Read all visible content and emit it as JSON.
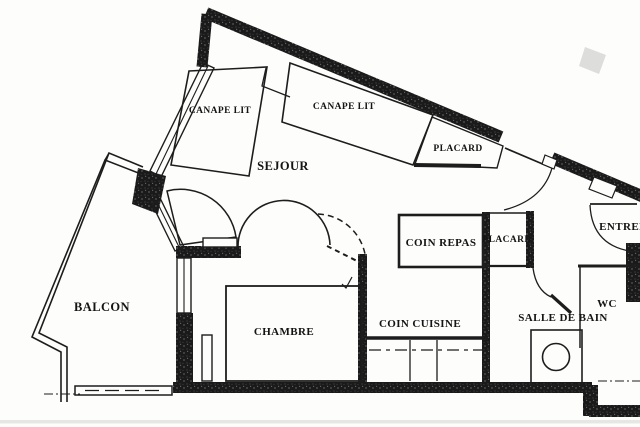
{
  "meta": {
    "type": "apartment-floor-plan",
    "language": "fr"
  },
  "colors": {
    "paper": "#fdfdfb",
    "ink": "#1d1d1d",
    "wall": "#171717",
    "scan_smudge": "#c8c8c8"
  },
  "labels": {
    "balcon": "BALCON",
    "sejour": "SEJOUR",
    "canape_lit_1": "CANAPE LIT",
    "canape_lit_2": "CANAPE LIT",
    "placard_haut": "PLACARD",
    "placard_bas": "PLACARD",
    "coin_repas": "COIN REPAS",
    "coin_cuisine": "COIN CUISINE",
    "chambre": "CHAMBRE",
    "salle_de_bain": "SALLE DE BAIN",
    "wc": "WC",
    "entree": "ENTREE"
  },
  "rooms": [
    {
      "id": "balcon",
      "label": "BALCON"
    },
    {
      "id": "sejour",
      "label": "SEJOUR"
    },
    {
      "id": "chambre",
      "label": "CHAMBRE"
    },
    {
      "id": "coin_cuisine",
      "label": "COIN CUISINE"
    },
    {
      "id": "coin_repas",
      "label": "COIN REPAS"
    },
    {
      "id": "salle_de_bain",
      "label": "SALLE DE BAIN"
    },
    {
      "id": "wc",
      "label": "WC"
    },
    {
      "id": "entree",
      "label": "ENTREE"
    }
  ],
  "furniture": [
    {
      "id": "canape_lit_1",
      "label": "CANAPE LIT",
      "room": "sejour"
    },
    {
      "id": "canape_lit_2",
      "label": "CANAPE LIT",
      "room": "sejour"
    },
    {
      "id": "placard_haut",
      "label": "PLACARD",
      "room": "sejour"
    },
    {
      "id": "placard_bas",
      "label": "PLACARD",
      "room": "coin_repas"
    },
    {
      "id": "lit_double",
      "label": "",
      "room": "chambre"
    },
    {
      "id": "plan_travail",
      "label": "",
      "room": "coin_cuisine"
    },
    {
      "id": "lavabo",
      "label": "",
      "room": "salle_de_bain"
    }
  ]
}
